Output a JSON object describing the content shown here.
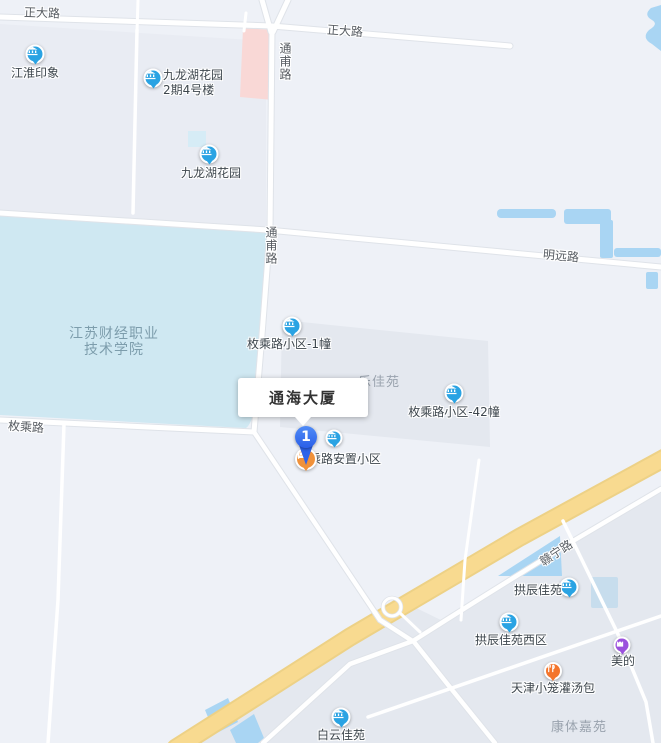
{
  "selected_place": {
    "name": "通海大厦",
    "marker_number": "1"
  },
  "roads": {
    "zhengda_w": "正大路",
    "zhengda_e": "正大路",
    "tongfu_n": "通甫路",
    "tongfu_s": "通甫路",
    "mingyuan": "明远路",
    "meicheng": "枚乘路",
    "ganning": "赣宁路"
  },
  "areas": {
    "college_line1": "江苏财经职业",
    "college_line2": "技术学院",
    "estate_partial": "乐佳苑",
    "kangti": "康体嘉苑"
  },
  "pois": [
    {
      "name": "江淮印象",
      "type": "blue-residence"
    },
    {
      "name": "九龙湖花园",
      "name2": "2期4号楼",
      "type": "blue-residence"
    },
    {
      "name": "九龙湖花园",
      "type": "blue-residence"
    },
    {
      "name": "枚乘路小区-1幢",
      "type": "blue-residence"
    },
    {
      "name": "枚乘路小区-42幢",
      "type": "blue-residence"
    },
    {
      "name": "乘路安置小区",
      "type": "blue-residence"
    },
    {
      "name": "",
      "type": "orange-residence"
    },
    {
      "name": "拱辰佳苑",
      "type": "blue-residence"
    },
    {
      "name": "拱辰佳苑西区",
      "type": "blue-residence"
    },
    {
      "name": "美的",
      "type": "purple-shop"
    },
    {
      "name": "天津小笼灌汤包",
      "type": "orange-food"
    },
    {
      "name": "白云佳苑",
      "type": "blue-residence"
    }
  ],
  "colors": {
    "background": "#eef1f7",
    "parcel": "#e6e9f0",
    "campus": "#cfe8f2",
    "water": "#a9d5f3",
    "pond_square": "#c7dded",
    "pink_building": "#f9d8d6",
    "highway_fill": "#f8da90",
    "highway_casing": "#edd186",
    "road_fill": "#ffffff",
    "road_casing": "#dfe3e9",
    "blue_poi": "#2aa3e3",
    "orange_poi": "#f0913a",
    "food_poi": "#f4752c",
    "purple_poi": "#9b51dd",
    "pin_blue": "#2e63ea",
    "info_text": "#333333",
    "road_label_text": "#565b61",
    "area_label_text": "#9aa3ae",
    "college_label_text": "#7d9dac"
  }
}
